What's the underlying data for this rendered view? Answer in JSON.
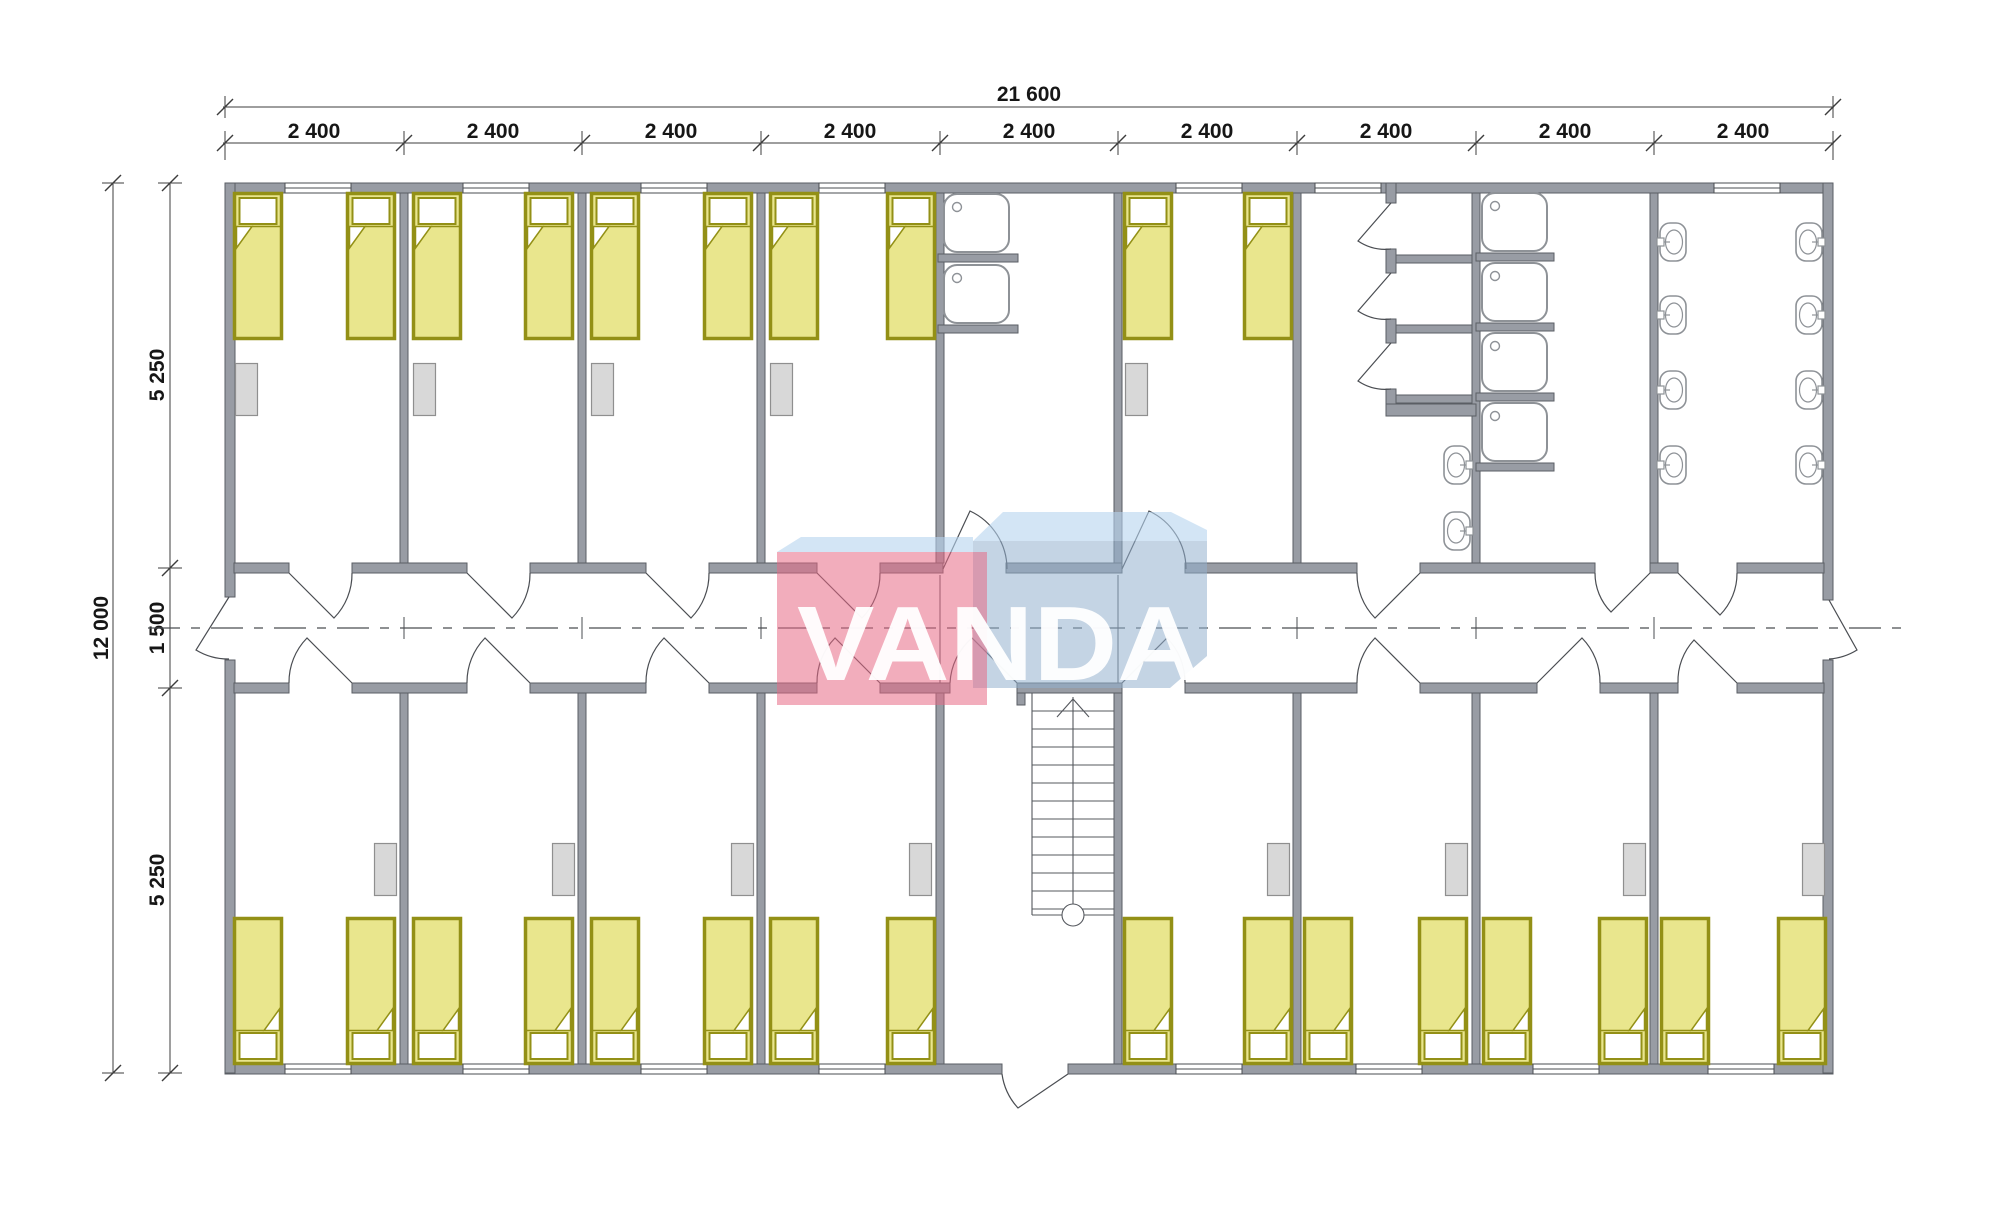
{
  "drawing": {
    "type": "floor-plan",
    "description": "Modular dormitory building floor plan, 9 modules of 2400 mm, central corridor, stair and entrance at bottom centre"
  },
  "dimensions": {
    "top_total": "21 600",
    "top_segments": [
      "2 400",
      "2 400",
      "2 400",
      "2 400",
      "2 400",
      "2 400",
      "2 400",
      "2 400",
      "2 400"
    ],
    "left_total": "12 000",
    "left_segments": [
      "5 250",
      "1 500",
      "5 250"
    ]
  },
  "watermark": {
    "text": "VANDA",
    "red_front": "rgba(231,106,133,0.55)",
    "top_band": "rgba(182,211,238,0.60)",
    "blue_front": "rgba(147,176,205,0.55)",
    "text_color": "rgba(255,255,255,0.95)"
  },
  "colors": {
    "wall_fill": "#989ca4",
    "wall_outline": "#5a5e64",
    "bed_fill": "#e9e68d",
    "bed_outline": "#939016",
    "wardrobe_fill": "#d8d8d8",
    "fixture_outline": "#8e9297",
    "line": "#4a4d52"
  },
  "inventory": {
    "bedrooms": 13,
    "beds": 26,
    "wardrobes": 13,
    "shower_trays": 6,
    "toilet_stalls": 3,
    "washbasins": 10,
    "corridor_exits": 2,
    "main_entrance": 1,
    "staircase": 1
  }
}
